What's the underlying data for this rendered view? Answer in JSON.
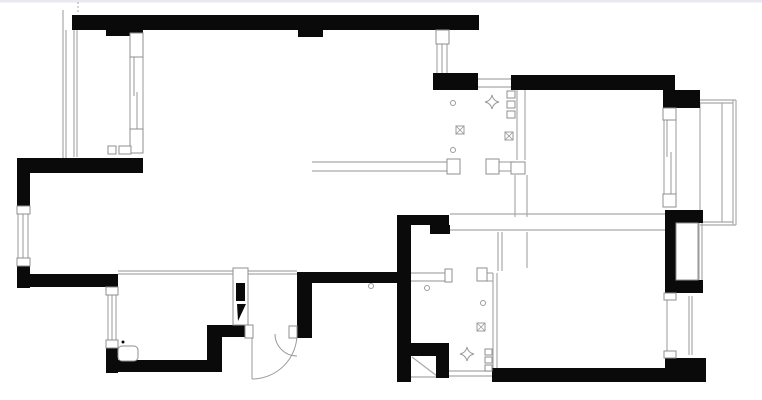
{
  "page": {
    "title": "apartment-floor-plan",
    "background": "#ffffff",
    "top_edge_color": "#e9e9f2"
  },
  "plan": {
    "canvas": {
      "width": 762,
      "height": 400
    },
    "colors": {
      "wall": "#0a0a0a",
      "thin": "#a9a9a9",
      "casing": "#8f8f8f",
      "symbol": "#9b9b9b",
      "fixture": "#8f8f8f"
    },
    "walls": [
      [
        72,
        15,
        407,
        15
      ],
      [
        106,
        30,
        37,
        6
      ],
      [
        298,
        30,
        25,
        7
      ],
      [
        433,
        73,
        45,
        17
      ],
      [
        511,
        75,
        164,
        15
      ],
      [
        663,
        90,
        37,
        18
      ],
      [
        17,
        158,
        126,
        15
      ],
      [
        17,
        158,
        13,
        54
      ],
      [
        17,
        260,
        13,
        28
      ],
      [
        17,
        274,
        100,
        13
      ],
      [
        106,
        274,
        12,
        20
      ],
      [
        106,
        342,
        12,
        31
      ],
      [
        106,
        360,
        116,
        12
      ],
      [
        207,
        325,
        15,
        47
      ],
      [
        207,
        325,
        40,
        12
      ],
      [
        297,
        272,
        15,
        66
      ],
      [
        293,
        326,
        19,
        12
      ],
      [
        299,
        272,
        98,
        11
      ],
      [
        397,
        215,
        14,
        167
      ],
      [
        397,
        215,
        52,
        10
      ],
      [
        430,
        225,
        20,
        9
      ],
      [
        397,
        343,
        52,
        13
      ],
      [
        436,
        356,
        13,
        22
      ],
      [
        492,
        368,
        214,
        14
      ],
      [
        665,
        358,
        41,
        24
      ],
      [
        665,
        210,
        11,
        83
      ],
      [
        665,
        210,
        38,
        13
      ],
      [
        665,
        280,
        38,
        13
      ]
    ],
    "thin_lines": [
      [
        63,
        10,
        63,
        158
      ],
      [
        66,
        30,
        66,
        158
      ],
      [
        74,
        30,
        74,
        157
      ],
      [
        77,
        30,
        77,
        157
      ],
      [
        130,
        57,
        130,
        129
      ],
      [
        143,
        57,
        143,
        129
      ],
      [
        134,
        55,
        134,
        96
      ],
      [
        137,
        92,
        137,
        131
      ],
      [
        18,
        212,
        18,
        260
      ],
      [
        23,
        212,
        23,
        260
      ],
      [
        28,
        212,
        28,
        260
      ],
      [
        108,
        294,
        108,
        342
      ],
      [
        112,
        294,
        112,
        342
      ],
      [
        116,
        294,
        116,
        342
      ],
      [
        437,
        44,
        437,
        73
      ],
      [
        442,
        44,
        442,
        73
      ],
      [
        447,
        44,
        447,
        73
      ],
      [
        478,
        79,
        511,
        79
      ],
      [
        478,
        87,
        511,
        87
      ],
      [
        118,
        271,
        297,
        271
      ],
      [
        118,
        274,
        297,
        274
      ],
      [
        312,
        162,
        447,
        162
      ],
      [
        312,
        171,
        447,
        171
      ],
      [
        499,
        162,
        515,
        162
      ],
      [
        499,
        171,
        515,
        171
      ],
      [
        517,
        90,
        517,
        160
      ],
      [
        525,
        90,
        525,
        160
      ],
      [
        515,
        175,
        515,
        217
      ],
      [
        527,
        175,
        527,
        217
      ],
      [
        450,
        214,
        665,
        214
      ],
      [
        450,
        230,
        665,
        230
      ],
      [
        498,
        232,
        498,
        271
      ],
      [
        502,
        232,
        502,
        271
      ],
      [
        527,
        232,
        527,
        268
      ],
      [
        664,
        120,
        664,
        194
      ],
      [
        676,
        120,
        676,
        194
      ],
      [
        667,
        120,
        667,
        157
      ],
      [
        671,
        152,
        671,
        194
      ],
      [
        700,
        100,
        736,
        100
      ],
      [
        700,
        103,
        733,
        103
      ],
      [
        700,
        222,
        733,
        222
      ],
      [
        700,
        225,
        736,
        225
      ],
      [
        722,
        103,
        722,
        222
      ],
      [
        733,
        100,
        733,
        225
      ],
      [
        736,
        100,
        736,
        225
      ],
      [
        700,
        103,
        700,
        222
      ],
      [
        699,
        213,
        699,
        290
      ],
      [
        702,
        213,
        702,
        290
      ],
      [
        667,
        293,
        667,
        358
      ],
      [
        689,
        296,
        689,
        355
      ],
      [
        692,
        296,
        692,
        355
      ],
      [
        448,
        371,
        492,
        371
      ],
      [
        448,
        376,
        492,
        376
      ],
      [
        411,
        273,
        445,
        273
      ],
      [
        411,
        281,
        445,
        281
      ],
      [
        486,
        273,
        493,
        273
      ],
      [
        486,
        281,
        493,
        281
      ],
      [
        493,
        273,
        493,
        368
      ],
      [
        497,
        273,
        497,
        368
      ],
      [
        411,
        377,
        448,
        377
      ],
      [
        412,
        357,
        437,
        376
      ],
      [
        252,
        334,
        252,
        379
      ],
      [
        120,
        351,
        136,
        351
      ]
    ],
    "dashed_lines": [
      [
        78,
        2,
        78,
        14
      ]
    ],
    "casings": [
      [
        130,
        33,
        13,
        24
      ],
      [
        130,
        129,
        13,
        24
      ],
      [
        17,
        206,
        13,
        8
      ],
      [
        17,
        258,
        13,
        8
      ],
      [
        106,
        287,
        12,
        8
      ],
      [
        106,
        340,
        12,
        8
      ],
      [
        436,
        30,
        13,
        14
      ],
      [
        447,
        159,
        13,
        15
      ],
      [
        486,
        159,
        13,
        15
      ],
      [
        511,
        162,
        14,
        12
      ],
      [
        663,
        108,
        13,
        12
      ],
      [
        663,
        194,
        13,
        13
      ],
      [
        664,
        293,
        12,
        7
      ],
      [
        664,
        351,
        12,
        7
      ],
      [
        445,
        269,
        7,
        13
      ],
      [
        477,
        268,
        10,
        13
      ],
      [
        245,
        325,
        8,
        13
      ],
      [
        289,
        326,
        8,
        12
      ],
      [
        676,
        223,
        22,
        57
      ],
      [
        233,
        268,
        15,
        57
      ],
      [
        108,
        146,
        8,
        8
      ],
      [
        119,
        146,
        12,
        8
      ],
      [
        507,
        91,
        8,
        7
      ],
      [
        507,
        101,
        8,
        7
      ],
      [
        507,
        111,
        8,
        7
      ],
      [
        485,
        349,
        7,
        6
      ],
      [
        485,
        357,
        7,
        6
      ],
      [
        485,
        365,
        7,
        6
      ]
    ],
    "solid_inserts": [
      [
        236,
        283,
        9,
        18
      ]
    ],
    "polygons": [
      "237,304 246,304 238,321"
    ],
    "door_arcs": [
      "M297,334 A45,45 0 0 1 252,379",
      "M275,334 A22,22 0 0 0 297,356"
    ],
    "rounded_fixtures": [
      [
        118,
        346,
        20,
        15
      ]
    ],
    "symbols": {
      "lights": [
        [
          453,
          103
        ],
        [
          453,
          150
        ],
        [
          427,
          288
        ],
        [
          483,
          303
        ],
        [
          371,
          286
        ]
      ],
      "floor_drains": [
        [
          456,
          126
        ],
        [
          505,
          132
        ],
        [
          477,
          323
        ]
      ],
      "vents": [
        [
          492,
          102
        ],
        [
          467,
          354
        ]
      ],
      "dots": [
        [
          123,
          342
        ]
      ]
    }
  }
}
